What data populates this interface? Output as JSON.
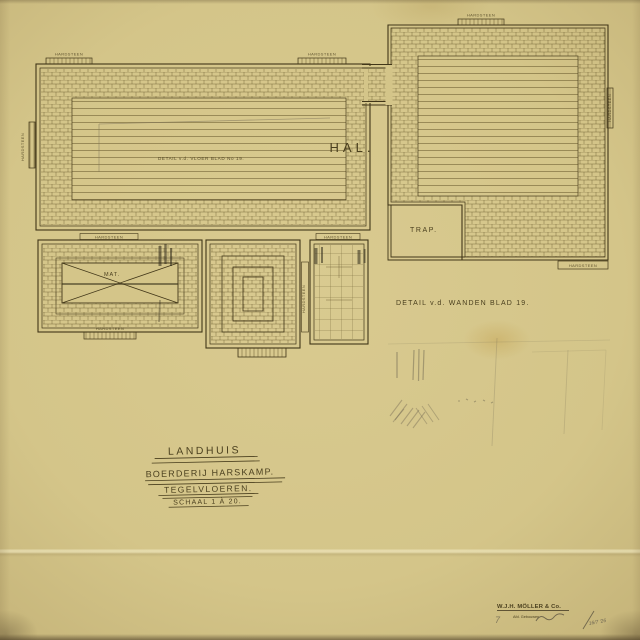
{
  "plan": {
    "hall_label": "HAL.",
    "stair_label": "TRAP.",
    "mat_label": "MAT.",
    "floor_detail_note": "DETAIL v.d. VLOER BLAD No 19.",
    "wall_detail_note": "DETAIL v.d. WANDEN  BLAD 19.",
    "threshold_label": "HARDSTEEN"
  },
  "title_block": {
    "line1": "LANDHUIS",
    "line2": "BOERDERIJ  HARSKAMP.",
    "line3": "TEGELVLOEREN.",
    "line4": "SCHAAL 1 À 20."
  },
  "stamp": {
    "company": "W.J.H. MÖLLER & Co.",
    "department": "Afd. Gebouwen",
    "signature": "16/7 '26"
  },
  "colors": {
    "paper": "#d6c78c",
    "ink": "#4a3f1e",
    "pencil": "#7a6f58"
  }
}
